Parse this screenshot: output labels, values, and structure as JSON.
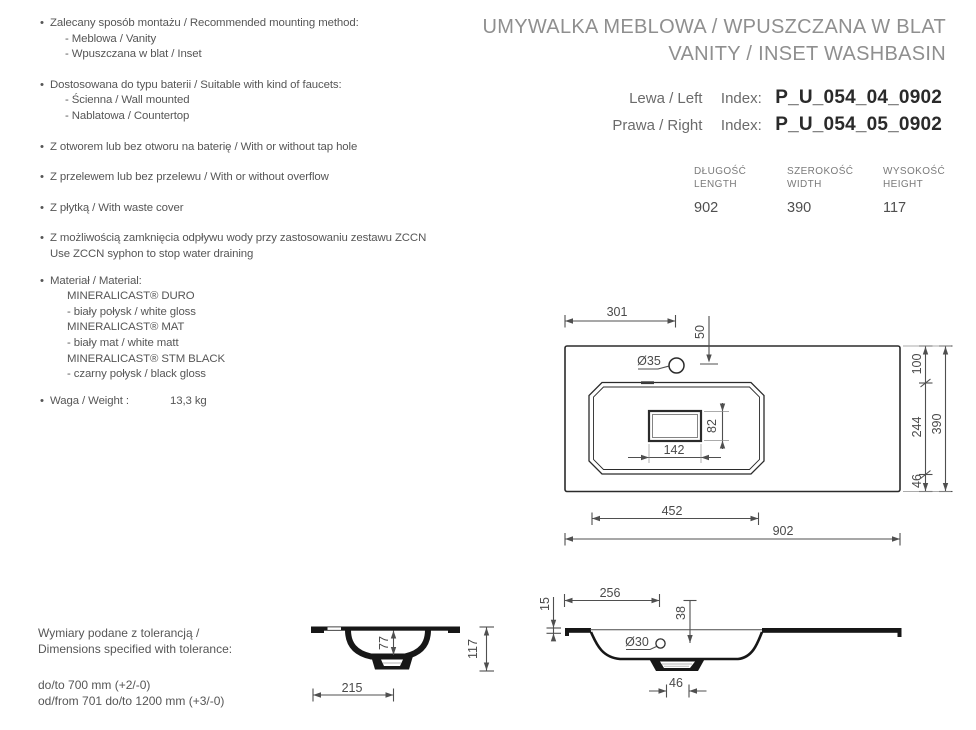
{
  "header": {
    "title_line1": "UMYWALKA MEBLOWA / WPUSZCZANA W BLAT",
    "title_line2": "VANITY / INSET WASHBASIN"
  },
  "index": {
    "left_label": "Lewa / Left",
    "right_label": "Prawa / Right",
    "index_word": "Index:",
    "left_code": "P_U_054_04_0902",
    "right_code": "P_U_054_05_0902"
  },
  "size_table": {
    "columns": [
      {
        "label_pl": "DŁUGOŚĆ",
        "label_en": "LENGTH",
        "value": "902"
      },
      {
        "label_pl": "SZEROKOŚĆ",
        "label_en": "WIDTH",
        "value": "390"
      },
      {
        "label_pl": "WYSOKOŚĆ",
        "label_en": "HEIGHT",
        "value": "117"
      }
    ]
  },
  "features": {
    "mounting_title": "Zalecany sposób montażu / Recommended mounting method:",
    "mounting_sub1": "- Meblowa / Vanity",
    "mounting_sub2": "- Wpuszczana w blat / Inset",
    "faucet_title": "Dostosowana do typu baterii / Suitable with kind of faucets:",
    "faucet_sub1": "- Ścienna / Wall mounted",
    "faucet_sub2": "- Nablatowa / Countertop",
    "tap_hole": "Z otworem lub bez otworu na baterię / With or without tap hole",
    "overflow": "Z przelewem lub bez przelewu / With or without overflow",
    "waste_cover": "Z płytką / With waste cover",
    "zccn_line1": "Z możliwością zamknięcia odpływu wody przy zastosowaniu zestawu ZCCN",
    "zccn_line2": "Use ZCCN syphon to stop water draining",
    "material_title": "Materiał / Material:",
    "material_1": "MINERALICAST® DURO",
    "material_1_desc": "- biały połysk / white gloss",
    "material_2": "MINERALICAST® MAT",
    "material_2_desc": "- biały mat / white matt",
    "material_3": "MINERALICAST® STM BLACK",
    "material_3_desc": "- czarny połysk / black gloss",
    "weight_label": "Waga / Weight :",
    "weight_value": "13,3 kg"
  },
  "tolerance": {
    "line1": "Wymiary podane z tolerancją /",
    "line2": "Dimensions specified with tolerance:",
    "rule1": "do/to 700 mm (+2/-0)",
    "rule2": "od/from 701 do/to 1200 mm (+3/-0)"
  },
  "dims": {
    "top_view": {
      "d301": "301",
      "d50": "50",
      "dia35": "Ø35",
      "d82": "82",
      "d142": "142",
      "d100": "100",
      "d244": "244",
      "d46": "46",
      "d390": "390",
      "d452": "452",
      "d902": "902"
    },
    "front_view": {
      "d77": "77",
      "d117": "117",
      "d215": "215"
    },
    "side_view": {
      "d15": "15",
      "d256": "256",
      "d38": "38",
      "dia30": "Ø30",
      "d46": "46"
    }
  }
}
